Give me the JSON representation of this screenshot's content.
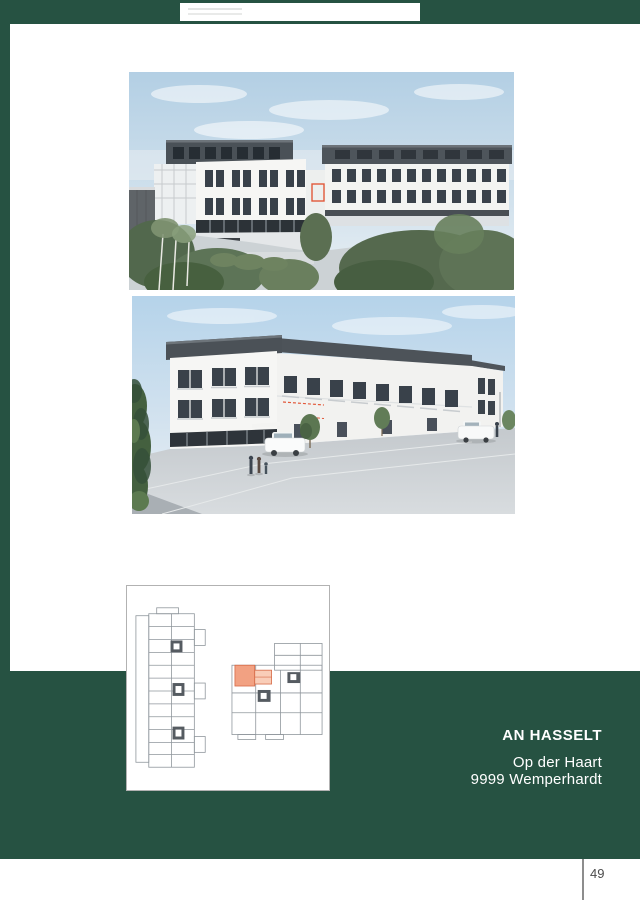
{
  "project": {
    "name": "AN HASSELT",
    "street": "Op der Haart",
    "city": "9999 Wemperhardt"
  },
  "footer": {
    "page_number": "49"
  },
  "colors": {
    "brand_green": "#265242",
    "highlight_orange": "#F2A182",
    "highlight_orange_border": "#D66A47",
    "divider_gray": "#8D8D8D",
    "page_number_gray": "#4C4C4C"
  }
}
